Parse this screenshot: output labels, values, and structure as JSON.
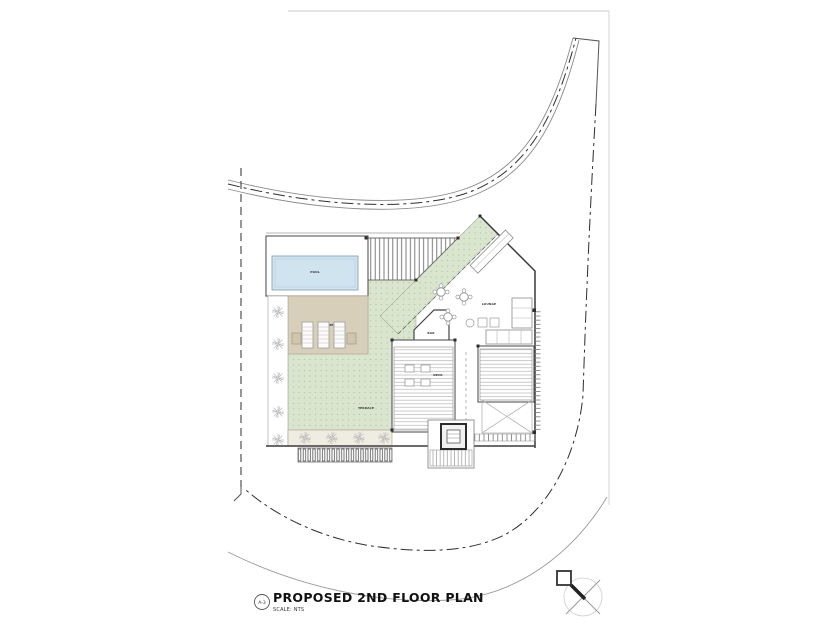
{
  "sheet": {
    "title": "PROPOSED 2ND FLOOR PLAN",
    "scale_label": "SCALE: NTS",
    "detail_ref": "A-3"
  },
  "plan": {
    "labels": {
      "pool": "POOL",
      "pool_deck": "POOL DECK",
      "terrace": "TERRACE",
      "bar_room": "BAR",
      "lounge": "LOUNGE",
      "deck_room": "DECK"
    }
  },
  "colors": {
    "terrace_green": "#dae5cf",
    "terrace_dot": "#b0c69c",
    "pool_blue": "#cfe4ef",
    "pool_edge": "#8ba6b6",
    "deck_tan": "#d8cfbb",
    "deck_edge": "#b9ae97",
    "line_dark": "#3a3a3a",
    "line_mid": "#777777",
    "line_light": "#bbbbbb"
  }
}
